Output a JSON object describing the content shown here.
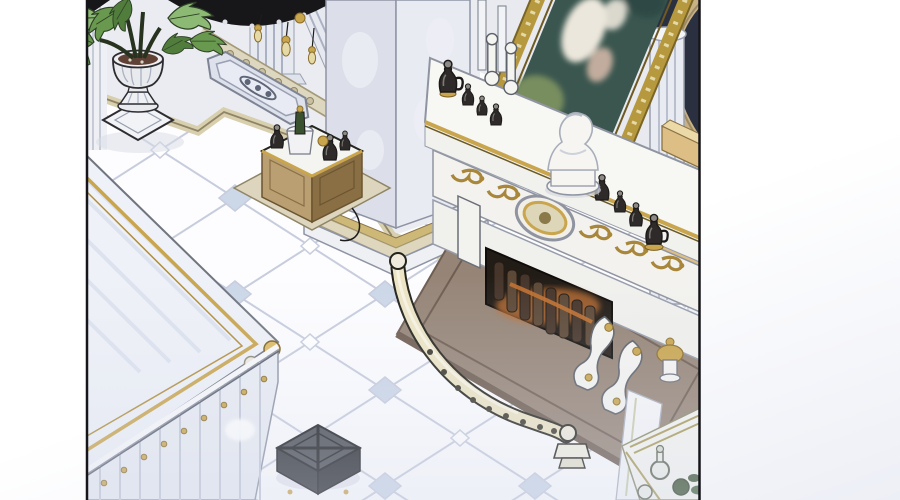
{
  "scene": {
    "type": "comic-panel-illustration",
    "description": "Isometric webtoon-style interior of an ornate palace salon: white marble tiled floor with pale blue diamond accents, a gilded fireplace with log firebox and brown stone hearth, a large gold rococo frame with a pastoral painting resting on the mantel, a white marble bust and dark glass bottles on the mantel shelf, a curved ivory fender rail, a monstera plant in a fluted stone urn, a liquor cabinet, a gold-trimmed marble desk, a dark tufted stool, fluted columns and a dark chandelier silhouette at the ceiling.",
    "no_visible_text": true
  },
  "objects": [
    "comic-panel",
    "chandelier-silhouette",
    "potted-monstera-plant",
    "stone-urn-pedestal",
    "wall-pilasters",
    "ornate-floor-plaque",
    "stair-molding",
    "marble-column",
    "liquor-cabinet",
    "gilded-picture-frame",
    "pastoral-painting",
    "marble-bust",
    "mantel-console",
    "glass-bottles",
    "frieze-medallion",
    "firebox-with-logs",
    "stone-hearth",
    "curved-fender-rail",
    "scroll-corbels",
    "gold-urn-finial",
    "right-columns",
    "gold-arch",
    "navy-ceiling-corner",
    "tan-wall-shelves",
    "corner-drinks-table",
    "marble-desk",
    "upholstered-stool",
    "tiled-marble-floor"
  ],
  "palette": {
    "panel_bg": "#f4f5f9",
    "floor_white": "#fdfdff",
    "floor_line": "#c7cddd",
    "floor_diamond": "#ccd7e8",
    "platform": "#ebecf2",
    "wall": "#e8eaf0",
    "stripe_light": "#d8cfae",
    "stripe_dark": "#8f8566",
    "column_left": "#dcdfe9",
    "column_right": "#e9ebf3",
    "gold": "#c9a54e",
    "gold_dark": "#8a6d2a",
    "gold_pale": "#e6d9a8",
    "ivory": "#ece4c4",
    "outline_dark": "#23231f",
    "navy": "#2b3040",
    "black": "#17171a",
    "hearth": "#968577",
    "hearth_dark": "#6e5d51",
    "firebox": "#221c17",
    "log": "#46352a",
    "log_light": "#5c4836",
    "ember": "#c07030",
    "frieze": "#f3f2ee",
    "mantel": "#f7f7f4",
    "frame_gold": "#b6993f",
    "painting_teal": "#3a564f",
    "painting_green": "#7f935f",
    "figure_white": "#ece7dc",
    "figure_pink": "#d9bbaa",
    "bust": "#f6f5f2",
    "cabinet_wood": "#b99f72",
    "cabinet_dark": "#8a6f45",
    "base_beige": "#ddd5bd",
    "leaf_light": "#8cba74",
    "leaf_mid": "#69984f",
    "leaf_dark": "#507c3c",
    "soil": "#5f4136",
    "glass_dark": "#2e2a29",
    "glass_green": "#39512f",
    "stool": "#45494f",
    "stool_dark": "#24262a",
    "desk_top": "#eef1f7",
    "desk_streak": "#dce1ef",
    "skirt": "#e9ecf3",
    "skirt_line": "#c3c9d8",
    "tan_shelf": "#ddbf85",
    "arch_tan": "#c8b184",
    "shadow": "#d8dce6"
  }
}
